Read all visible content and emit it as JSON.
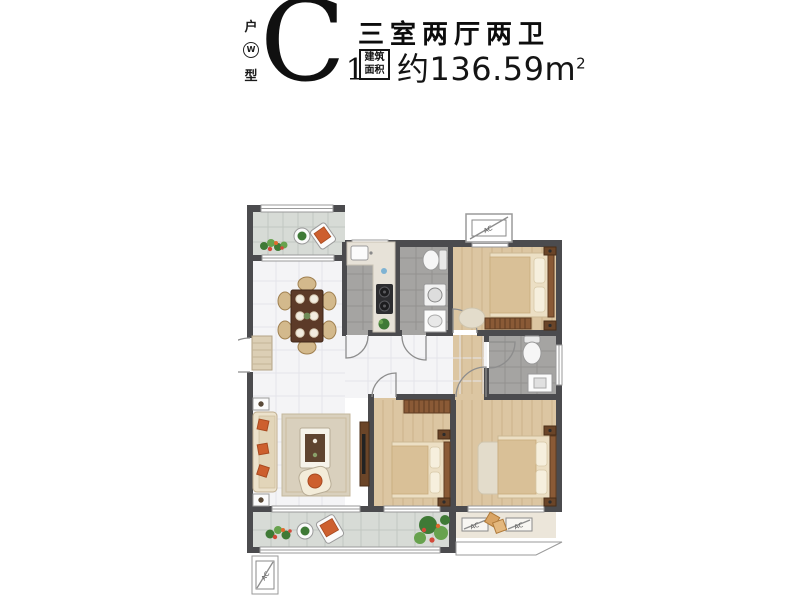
{
  "header": {
    "vertical_label_top": "户",
    "vertical_label_bottom": "型",
    "logo_glyph": "W",
    "unit_code": "C",
    "unit_code_subscript": "1",
    "layout_title": "三室两厅两卫",
    "area_tag_line1": "建筑",
    "area_tag_line2": "面积",
    "area_value": "约136.59m",
    "area_superscript": "2"
  },
  "floorplan": {
    "ac_label": "AC",
    "colors": {
      "wall": "#4b4b4e",
      "wood_floor": "#dcc6a2",
      "tile_gray": "#a5a4a2",
      "tile_white": "#f4f4f6",
      "balcony_tile": "#d7dbd6",
      "ac_platform": "#ece6da",
      "accent_orange": "#cd5f2e",
      "plant_green": "#4e8c3f"
    },
    "rooms": [
      {
        "id": "balcony-north"
      },
      {
        "id": "dining-living"
      },
      {
        "id": "kitchen"
      },
      {
        "id": "bathroom-1"
      },
      {
        "id": "bedroom-1"
      },
      {
        "id": "corridor"
      },
      {
        "id": "bathroom-2"
      },
      {
        "id": "bedroom-2"
      },
      {
        "id": "master-bedroom"
      },
      {
        "id": "balcony-south"
      },
      {
        "id": "ac-platform"
      }
    ]
  }
}
